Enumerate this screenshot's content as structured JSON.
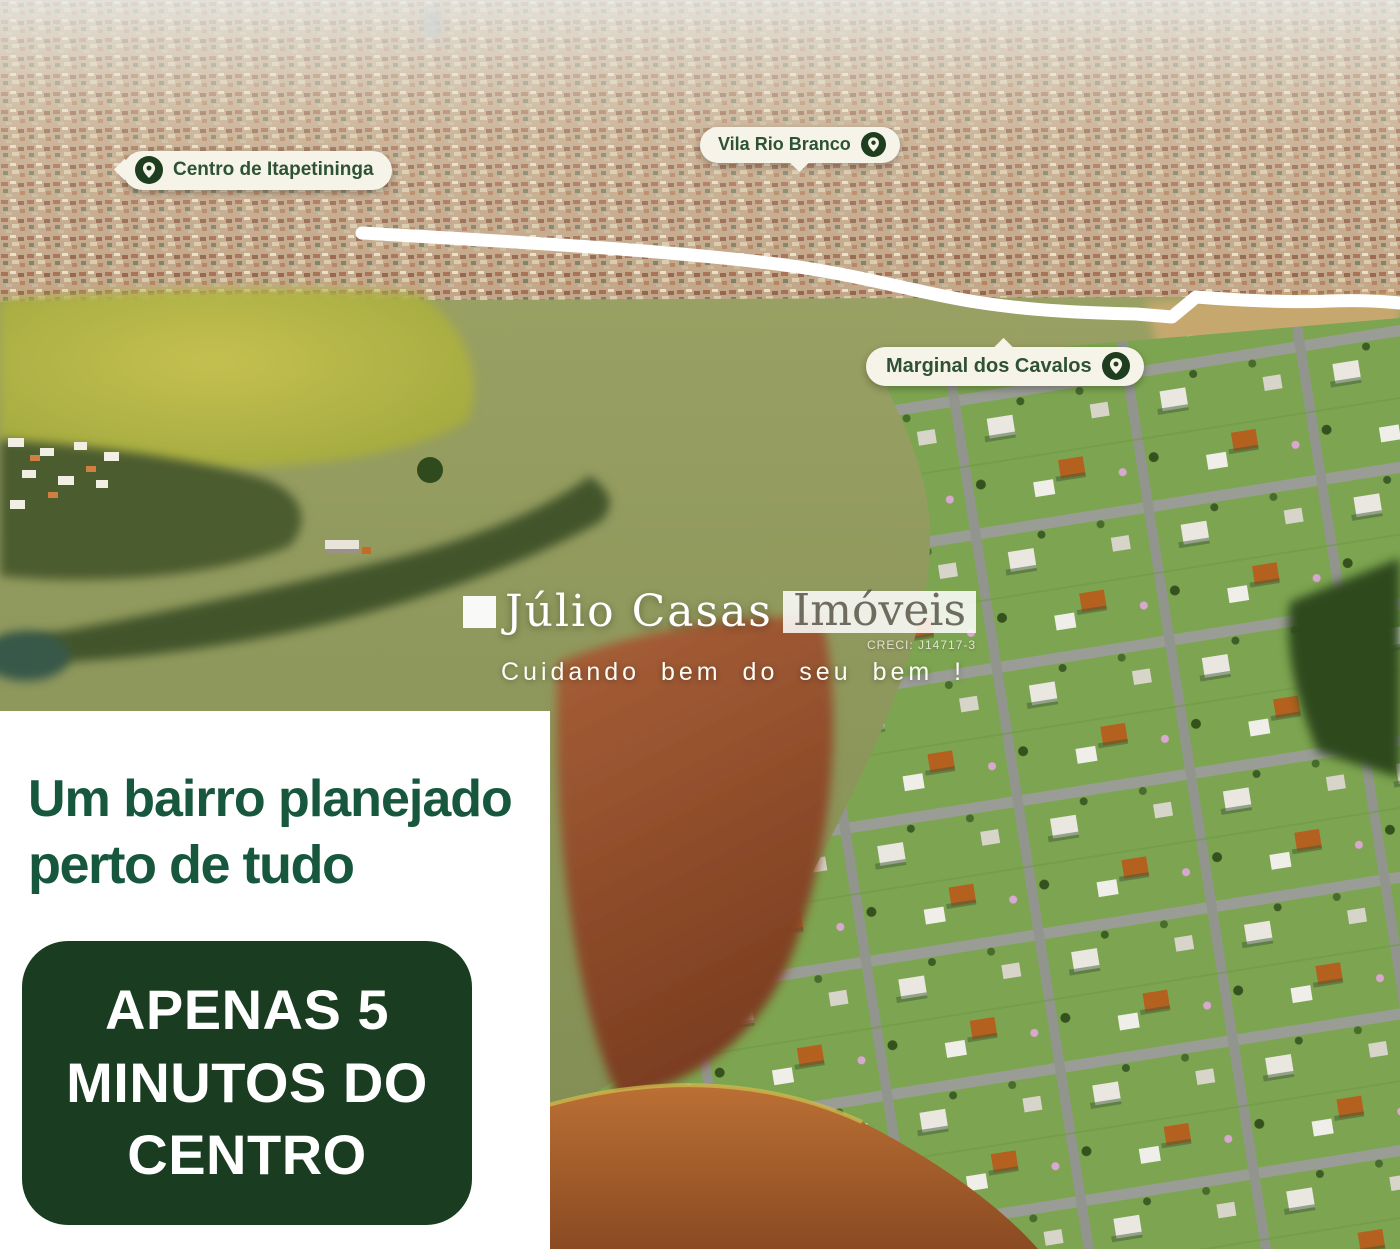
{
  "badges": [
    {
      "label": "Centro de Itapetininga",
      "icon": "map-pin-icon"
    },
    {
      "label": "Vila Rio Branco",
      "icon": "map-pin-icon"
    },
    {
      "label": "Marginal dos Cavalos",
      "icon": "map-pin-icon"
    }
  ],
  "watermark": {
    "brand_first": "Júlio Casas",
    "brand_second": "Imóveis",
    "registration": "CRECI: J14717-3",
    "tagline": "Cuidando bem do seu bem !"
  },
  "panel": {
    "headline_line1": "Um bairro planejado",
    "headline_line2": "perto de tudo",
    "cta_line1": "APENAS 5",
    "cta_line2": "MINUTOS DO",
    "cta_line3": "CENTRO"
  },
  "colors": {
    "cta_box_green": "#1a3d21",
    "headline_green": "#17573e",
    "badge_text_green": "#2e5233",
    "badge_background_cream": "#f6f4e8",
    "pin_icon_green": "#1f3d1f",
    "panel_white": "#ffffff",
    "road_highlight_white": "#ffffff",
    "lawn_green": "#7da551",
    "dirt_red": "#8a4a22"
  }
}
